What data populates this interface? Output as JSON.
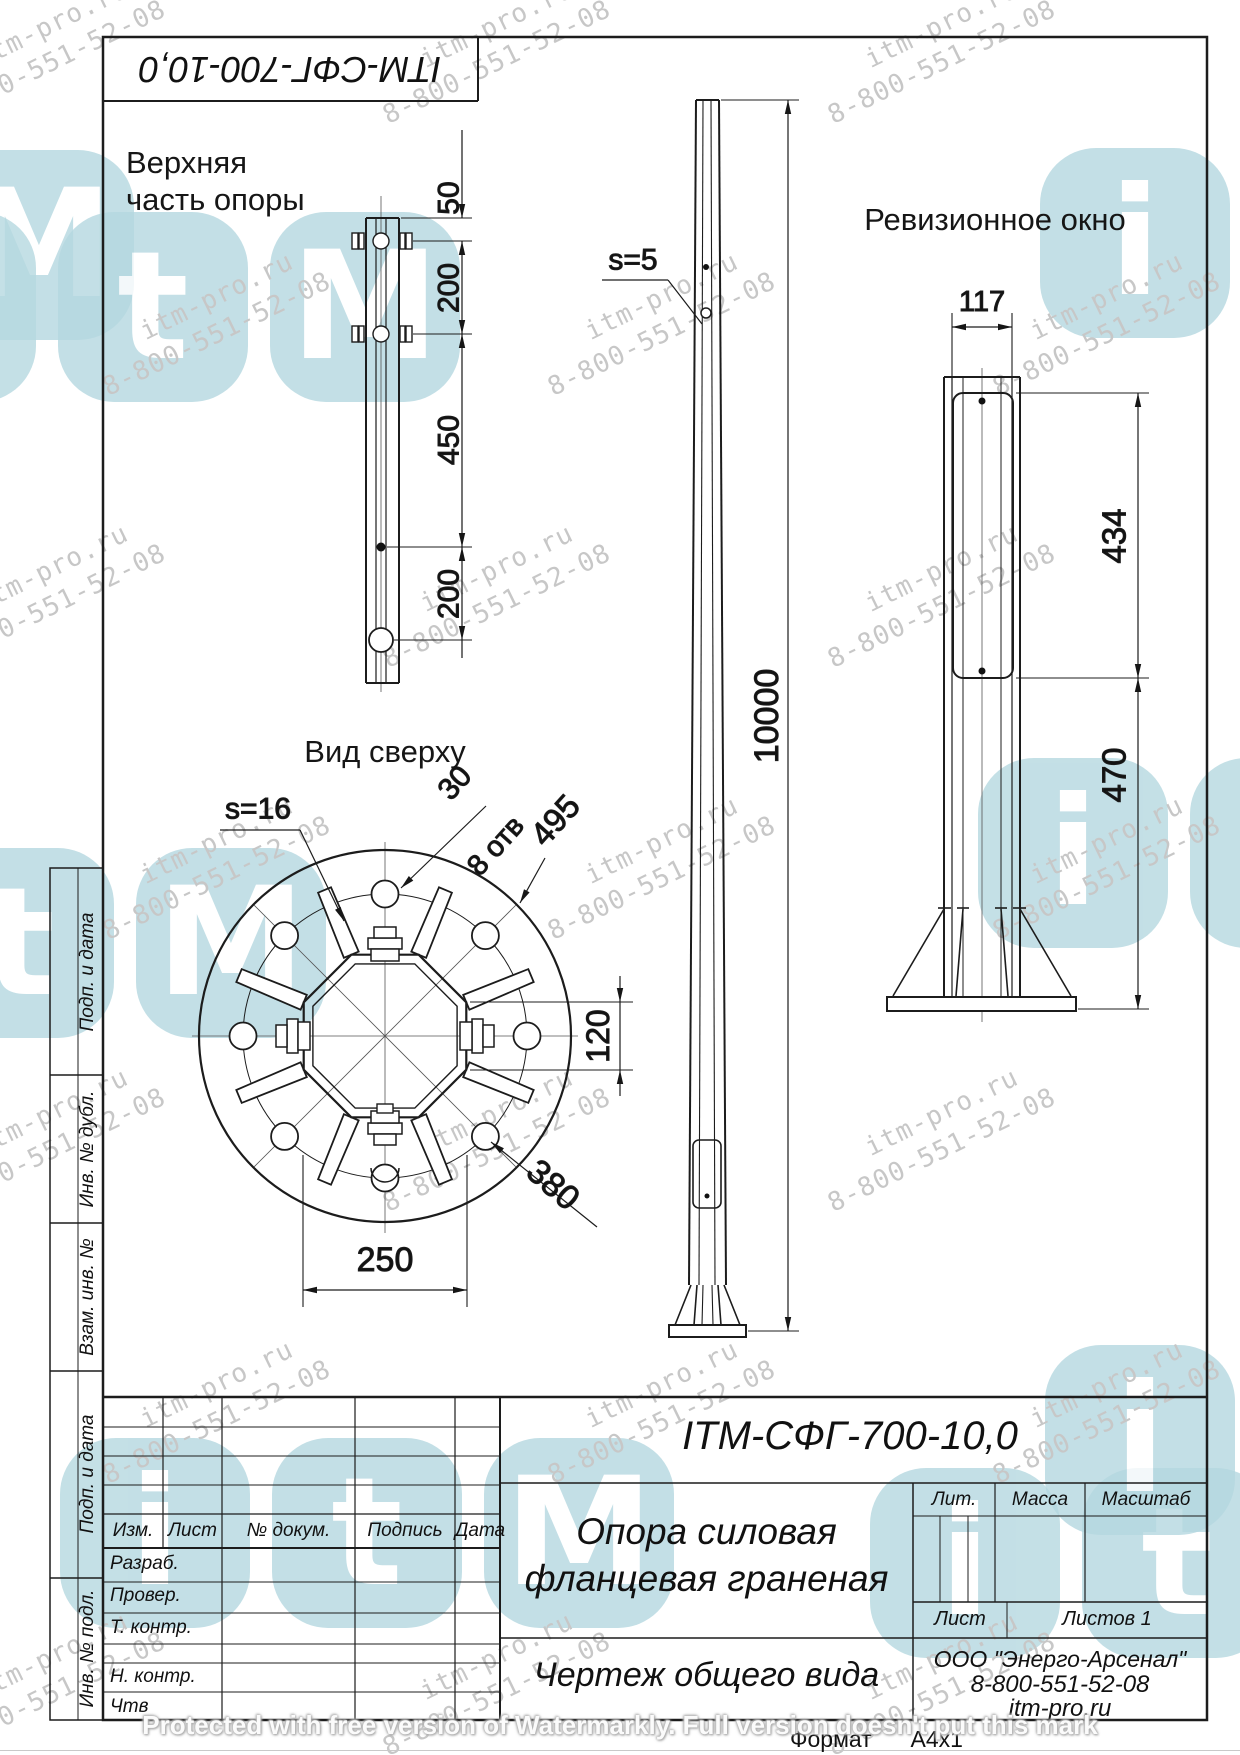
{
  "watermark": {
    "site": "itm-pro.ru",
    "phone": "8-800-551-52-08",
    "protected_text": "Protected with free version of Watermarkly. Full version doesn't put this mark",
    "logo_letters": [
      "i",
      "t",
      "M"
    ],
    "logo_color": "#b5d8e0",
    "text_color": "#c7c7c7"
  },
  "sheet": {
    "designation_top": "ITM-СФГ-700-10,0",
    "format_label": "Формат",
    "format_value": "А4х1"
  },
  "side_column": {
    "labels": [
      "Подп. и дата",
      "Инв. № дубл.",
      "Взам. инв. №",
      "Подп. и дата",
      "Инв. № подл."
    ]
  },
  "views": {
    "top_detail": {
      "title": "Верхняя\nчасть опоры",
      "dims": {
        "d50": "50",
        "d200a": "200",
        "d450": "450",
        "d200b": "200"
      }
    },
    "elevation": {
      "wall_label": "s=5",
      "height": "10000"
    },
    "revision": {
      "title": "Ревизионное окно",
      "width": "117",
      "window_height": "434",
      "bottom_offset": "470"
    },
    "top_view": {
      "title": "Вид сверху",
      "thickness": "s=16",
      "hole_dia": "30",
      "holes_note": "8 отв",
      "outer_dia": "495",
      "flat": "120",
      "bolt_circle": "380",
      "width": "250"
    }
  },
  "title_block": {
    "doc_number": "ITM-СФГ-700-10,0",
    "title_line1": "Опора силовая",
    "title_line2": "фланцевая граненая",
    "doc_type": "Чертеж общего вида",
    "company": "ООО \"Энерго-Арсенал\"",
    "company_phone": "8-800-551-52-08",
    "company_site": "itm-pro.ru",
    "headers": {
      "lit": "Лит.",
      "mass": "Масса",
      "scale": "Масштаб",
      "sheet": "Лист",
      "sheets": "Листов 1",
      "izm": "Изм.",
      "list": "Лист",
      "doc": "№ докум.",
      "sign": "Подпись",
      "date": "Дата"
    },
    "rows": {
      "developed": "Разраб.",
      "checked": "Провер.",
      "tcontrol": "Т. контр.",
      "ncontrol": "Н. контр.",
      "approved": "Чтв"
    }
  }
}
